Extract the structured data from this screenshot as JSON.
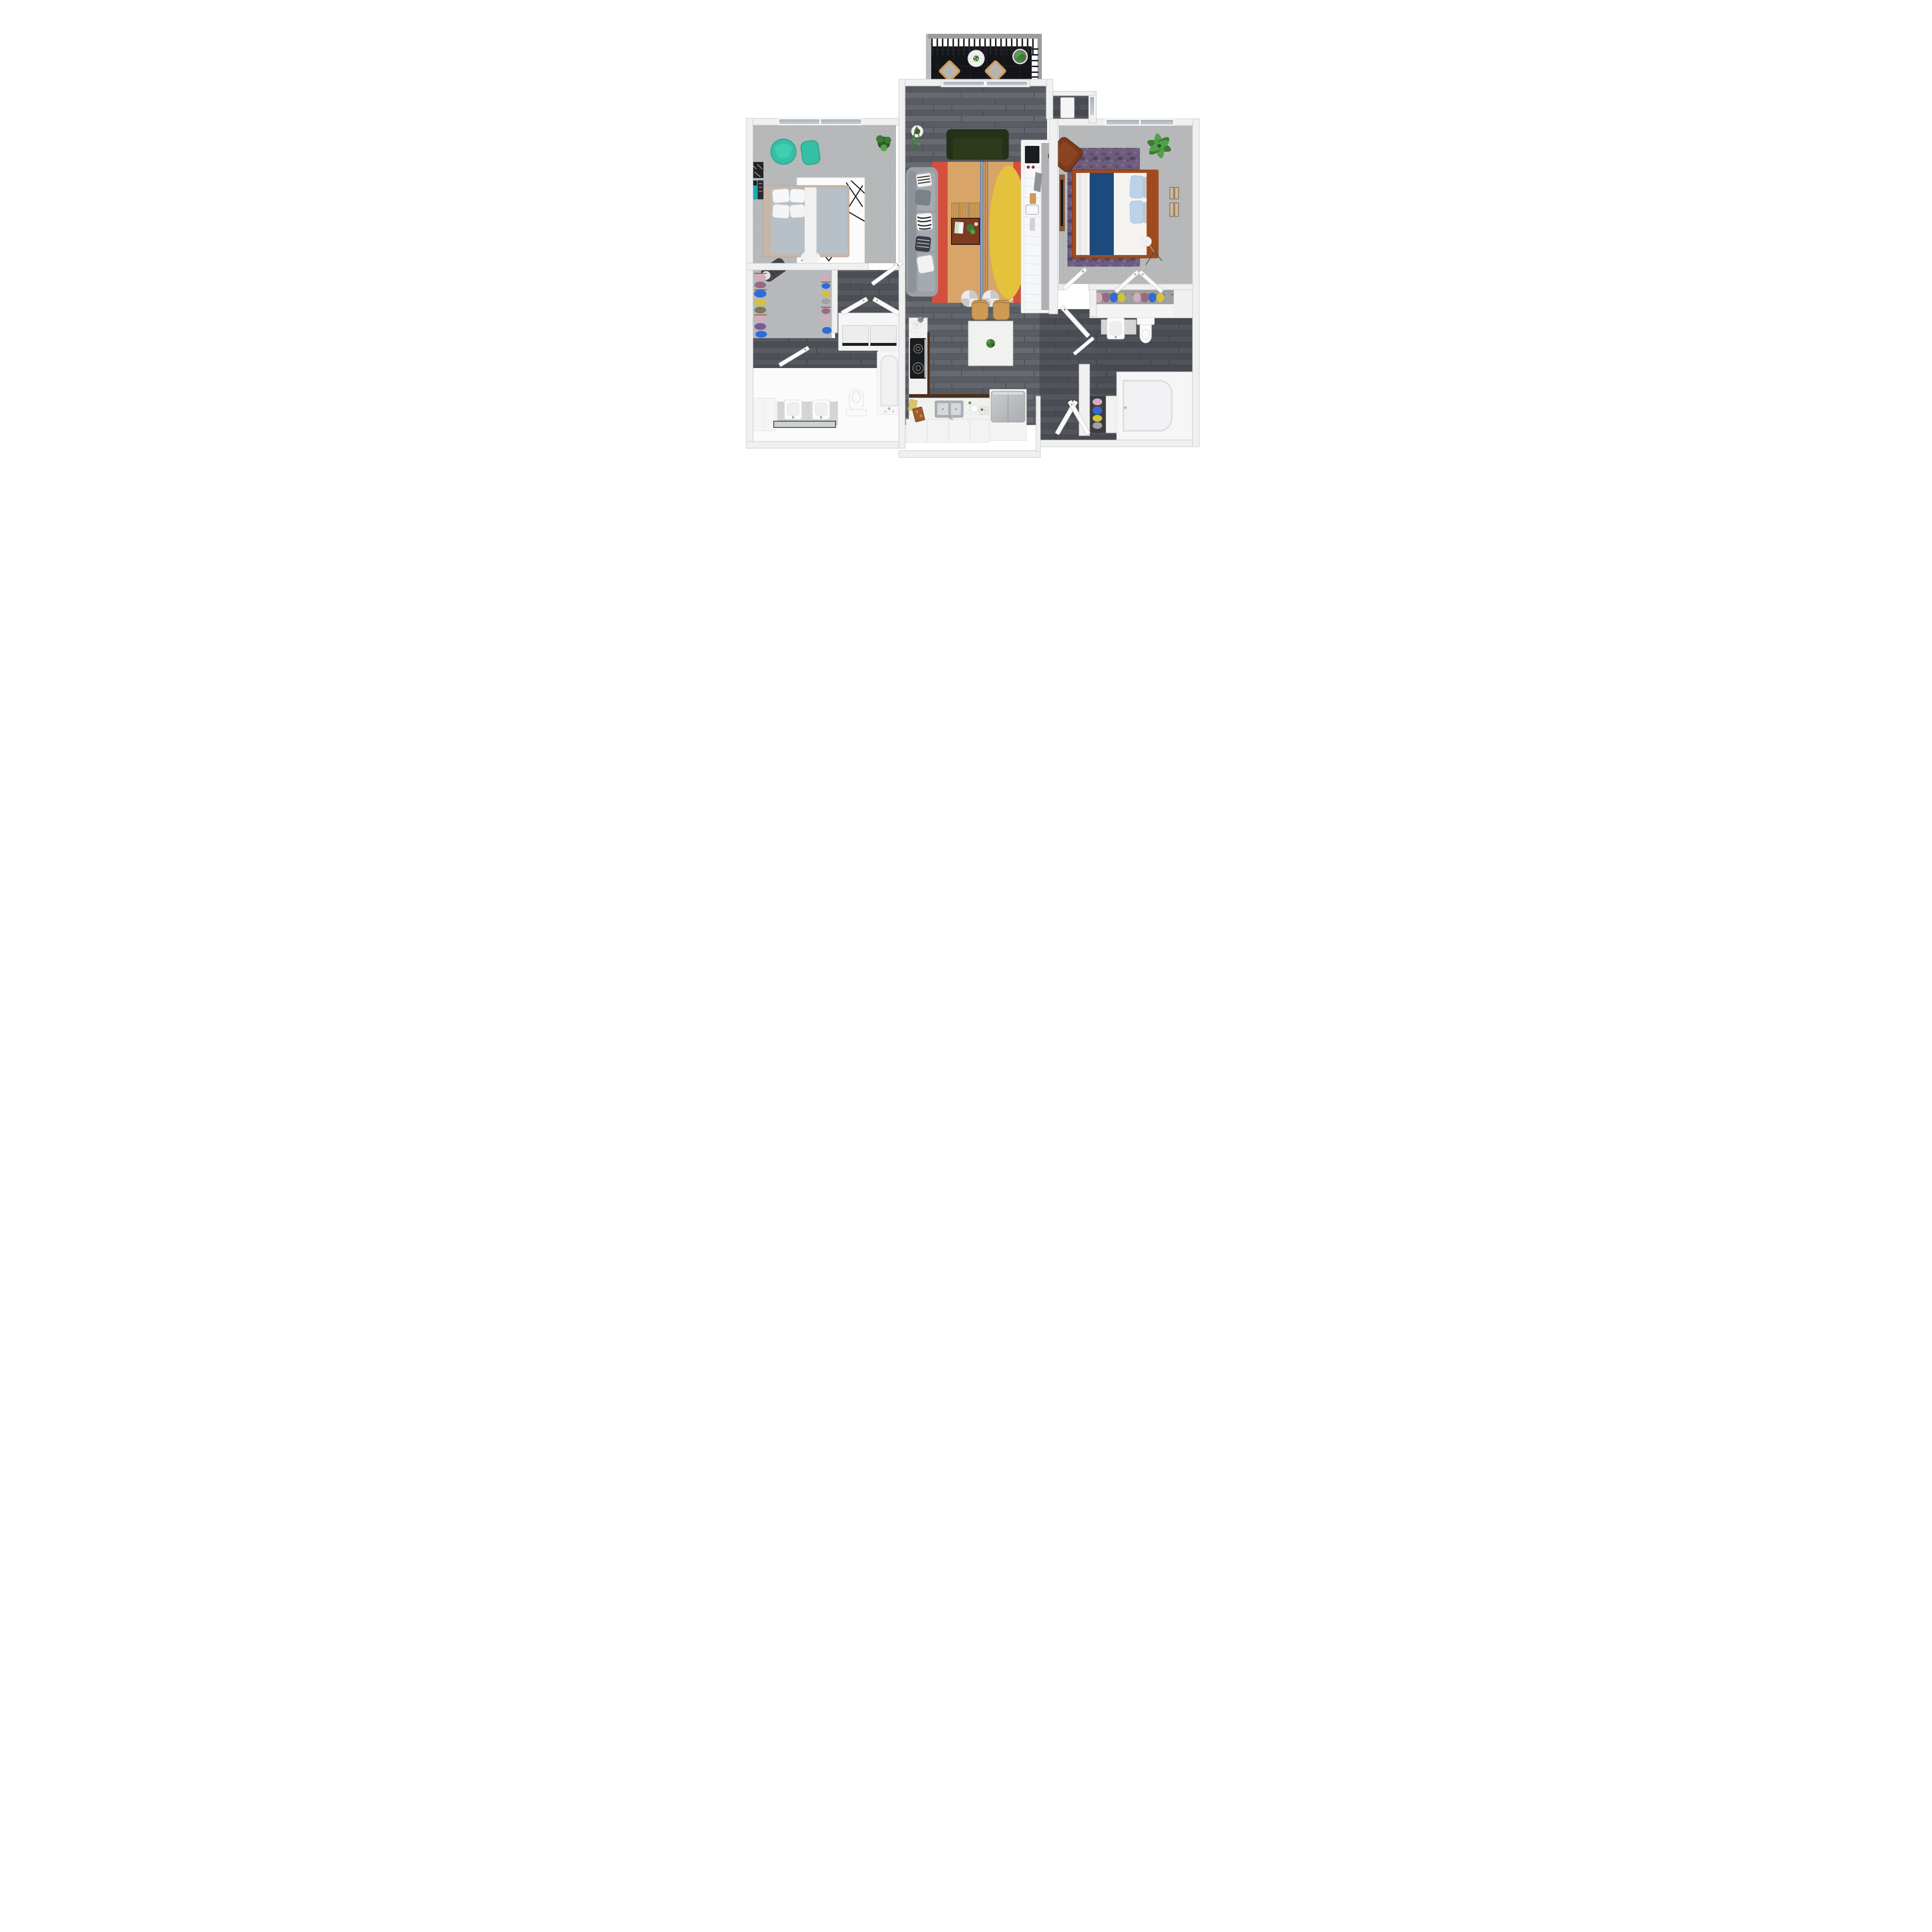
{
  "meta": {
    "type": "3d-floor-plan-render",
    "description": "Top-down 3D rendering of a two-bedroom, two-bathroom apartment floor plan with a balcony, open living room, kitchen with island, walk-in closets, laundry closet and entry hall",
    "bedrooms": 2,
    "bathrooms": 2,
    "visible_text": ""
  },
  "palette": {
    "outside": "#ffffff",
    "wall": "#f0f0f1",
    "wall-edge": "#c7c8ca",
    "niche": "#f6f6f7",
    "glass-top": "#a8aeb5",
    "glass-bottom": "#ccd1d5",
    "wood-1": "#676b71",
    "wood-2": "#5a5e64",
    "wood-3": "#63676d",
    "wood-4": "#565a60",
    "wood-seam": "#45494f",
    "dark-overlay": "#23252a",
    "carpet-1": "#b6b8ba",
    "carpet-2": "#aeb0b2",
    "carpet-3": "#c0c2c4",
    "tile-1": "#141519",
    "tile-2": "#2c2e32",
    "speckle-1": "#f2f2f0",
    "granite-1": "#d5d5d3",
    "granite-d": "#b6b6b4",
    "marble-1": "#f6f7f9",
    "marble-v": "#dadde3",
    "teal": "#35bfa4",
    "teal-dark": "#2aa58d",
    "rug-red": "#d4503c",
    "rug-tan": "#d9a468",
    "rug-yellow": "#e4c23b",
    "rug-cream": "#e9e0cc",
    "rug-blue": "#4f86c6",
    "rug-orange-line": "#c57a3a",
    "sofa-gray": "#9aa0a5",
    "sofa-gray-edge": "#868c91",
    "sofa-cushion": "#a4aaaf",
    "sofa-back": "#8d9399",
    "green-sofa": "#2d3a1c",
    "green-sofa-dark": "#243018",
    "wood-furn-1": "#cf9a55",
    "wood-furn-2": "#ae7a3a",
    "table-wood": "#7c3a1f",
    "table-edge": "#2e1d12",
    "navy": "#1c4a7e",
    "rust": "#a34c1f",
    "rust-dark": "#8a3d15",
    "blue-pillow": "#bcd2e8",
    "blue-pillow-edge": "#a6c0d8",
    "gray-pillow": "#c2c5c9",
    "brown-chair": "#7c3a1d",
    "brown-chair-dark": "#662d12",
    "shag-1": "#6d5c7c",
    "shag-2": "#5a4b6b",
    "shag-3": "#4e4260",
    "shag-4": "#857093",
    "plant-dark": "#2f5a2a",
    "plant": "#3e7a33",
    "plant-light": "#54a04a",
    "pot-white": "#f1f1ef",
    "soil": "#5b3f33",
    "stainless": "#aeb2b5",
    "steel-1": "#c9ccce",
    "steel-2": "#a9adb0",
    "basin": "#d6d9db",
    "black-appliance": "#1b1c1e",
    "burner": "#8a8d90",
    "knob": "#7c3538",
    "brass": "#b89a55",
    "door": "#fcfcfd",
    "door-edge": "#c6c7c9",
    "mirror": "#ccd1d4",
    "mirror-edge": "#35363a",
    "white-fixture": "#fbfbfc",
    "fixture-edge": "#d9d9db",
    "fixture-inner": "#efeff1",
    "tub-inner": "#f1f1f3",
    "cloth-pink": "#d8aabf",
    "cloth-plum": "#9a6a82",
    "cloth-blue": "#2f6bd8",
    "cloth-yellow": "#d4c238",
    "cloth-olive": "#7a7a5a",
    "cloth-gray": "#9fa0a2",
    "cloth-purple": "#7a5a9a",
    "hanger": "#7a4a2a",
    "railing": "#9b9c9e",
    "railing-slat": "#222326",
    "hamper": "#46474b",
    "rug-white": "#fbfbfb",
    "rug-line": "#1c1c1e",
    "bed1-frame": "#c7b6a6",
    "bed1-blanket": "#b7bfc7",
    "art-teal": "#14b0ba",
    "art-dark": "#232325"
  },
  "rooms": [
    {
      "name": "balcony",
      "floor": "black tile",
      "furniture": [
        "railing",
        "two patio chairs",
        "round table with plant",
        "potted plant"
      ]
    },
    {
      "name": "living-room",
      "floor": "gray wood plank",
      "furniture": [
        "gray sofa with pillows",
        "green loveseat",
        "multicolor rug",
        "coffee table with bench",
        "two round ottomans",
        "hanging plant"
      ]
    },
    {
      "name": "kitchen",
      "floor": "gray wood plank",
      "furniture": [
        "L-counter with stove and double sink",
        "island with plant",
        "two wood stools",
        "refrigerator",
        "bar peninsula with cooktop"
      ]
    },
    {
      "name": "bedroom-1",
      "floor": "gray carpet",
      "furniture": [
        "bed with gray blanket",
        "white geometric rug",
        "teal armchair and ottoman",
        "plant",
        "wall art",
        "hamper"
      ]
    },
    {
      "name": "walk-in-closet-1",
      "floor": "gray carpet",
      "furniture": [
        "hanging clothes both sides"
      ]
    },
    {
      "name": "laundry-closet",
      "floor": "wood",
      "furniture": [
        "washer",
        "dryer",
        "bifold doors"
      ]
    },
    {
      "name": "bathroom-1",
      "floor": "white",
      "furniture": [
        "double vanity",
        "mirror",
        "toilet",
        "bathtub",
        "cabinet"
      ]
    },
    {
      "name": "entry-hall",
      "floor": "dark wood plank",
      "furniture": [
        "entry door",
        "louvered closet doors",
        "coat closet with clothes"
      ]
    },
    {
      "name": "bedroom-2",
      "floor": "gray carpet",
      "furniture": [
        "bed with navy runner and blue pillows",
        "purple shag rug",
        "brown armchair",
        "palm plant",
        "tv dresser",
        "floor lamp",
        "wall art",
        "closet doors"
      ]
    },
    {
      "name": "closet-2",
      "floor": "gray carpet",
      "furniture": [
        "hanging clothes row",
        "shelf"
      ]
    },
    {
      "name": "bathroom-2",
      "floor": "dark wood plank",
      "furniture": [
        "vanity sink",
        "toilet",
        "bathtub",
        "linen closet"
      ]
    }
  ],
  "closet1_clothes": [
    "cloth-pink",
    "cloth-plum",
    "cloth-blue",
    "cloth-yellow",
    "cloth-olive",
    "cloth-pink",
    "cloth-purple"
  ],
  "closet2_clothes": [
    "cloth-pink",
    "cloth-plum",
    "cloth-blue",
    "cloth-yellow",
    "cloth-gray",
    "cloth-pink",
    "cloth-plum",
    "cloth-blue",
    "cloth-yellow",
    "cloth-gray"
  ],
  "entry_closet_clothes": [
    "cloth-pink",
    "cloth-blue",
    "cloth-yellow",
    "cloth-gray"
  ]
}
